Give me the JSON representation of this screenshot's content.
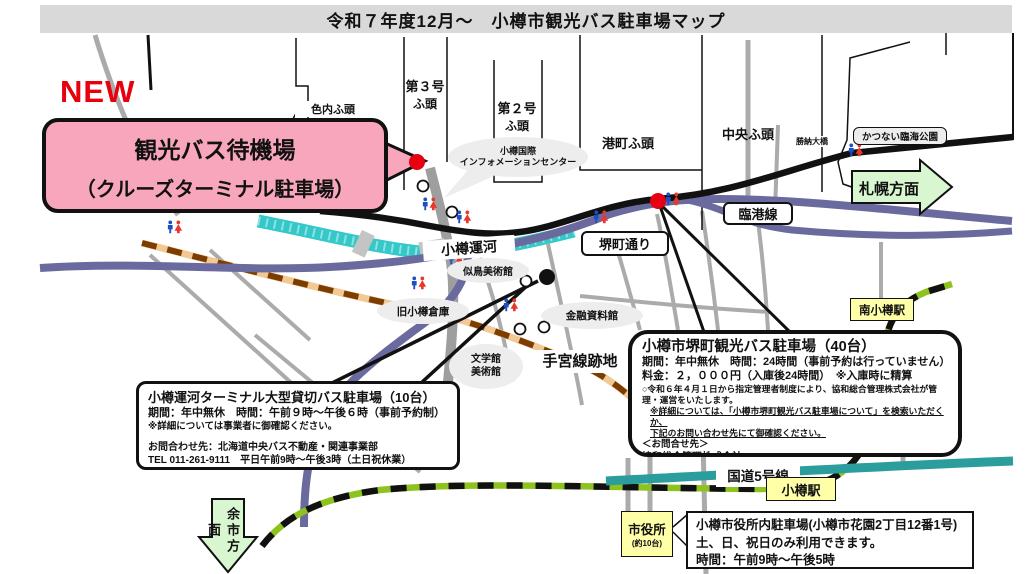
{
  "title": "令和７年度12月～　小樽市観光バス駐車場マップ",
  "new_badge": "NEW",
  "waiting_bubble": {
    "line1": "観光バス待機場",
    "line2": "（クルーズターミナル駐車場）"
  },
  "labels": {
    "ironai_pier": "色内ふ頭",
    "pier3_line1": "第３号",
    "pier3_line2": "ふ頭",
    "pier2_line1": "第２号",
    "pier2_line2": "ふ頭",
    "minatomachi_pier": "港町ふ頭",
    "chuo_pier": "中央ふ頭",
    "katsunai_park": "かつない臨海公園",
    "katsunai_bridge": "勝納大橋",
    "sapporo_direction": "札幌方面",
    "rinko_line": "臨港線",
    "otaru_canal": "小樽運河",
    "sakaimachi_street": "堺町通り",
    "info_center_line1": "小樽国際",
    "info_center_line2": "インフォメーションセンター",
    "nitori_museum": "似鳥美術館",
    "former_warehouse": "旧小樽倉庫",
    "finance_museum": "金融資料館",
    "literature_line1": "文学館",
    "literature_line2": "美術館",
    "temiya_site": "手宮線跡地",
    "minami_otaru_station": "南小樽駅",
    "otaru_station": "小樽駅",
    "route5": "国道5号線",
    "yoichi_direction": "余市方面",
    "city_hall": "市役所",
    "city_hall_capacity": "(約10台)"
  },
  "canal_box": {
    "title": "小樽運河ターミナル大型貸切バス駐車場（10台）",
    "period": "期間：年中無休　時間：午前９時～午後６時（事前予約制）",
    "note": "※詳細については事業者に御確認ください。",
    "contact1": "お問合わせ先：北海道中央バス不動産・関連事業部",
    "contact2": "TEL 011-261-9111　平日午前9時～午後3時（土日祝休業）"
  },
  "sakaimachi_box": {
    "title": "小樽市堺町観光バス駐車場（40台）",
    "period": "期間：年中無休　時間：24時間（事前予約は行っていません）",
    "fee": "料金：２，０００円（入庫後24時間）　※入庫時に精算",
    "note1": "○令和６年４月１日から指定管理者制度により、協和総合管理株式会社が管理・運営をいたします。",
    "note2": "※詳細については、「小樽市堺町観光バス駐車場について」を検索いただくか、",
    "note3": "下記のお問い合わせ先にて御確認ください。",
    "contact_header": "＜お問合せ先＞",
    "contact": "協和総合管理株式会社　TEL：0134-27-2233"
  },
  "cityhall_box": {
    "line1": "小樽市役所内駐車場(小樽市花園2丁目12番1号)",
    "line2": "土、日、祝日のみ利用できます。",
    "line3": "時間：午前9時～午後5時"
  },
  "colors": {
    "title_band": "#d9d9d9",
    "accent_pink": "#f7a6bb",
    "new_red": "#e8000e",
    "marker_red": "#e60012",
    "arrow_green": "#d8f6d0",
    "station_yellow": "#ffffa8",
    "canal_teal": "#35c8c8",
    "route5_teal": "#2b9d9d",
    "road_purple": "#6a6a9f",
    "rail_green": "#8dc21f",
    "temiya_tan": "#f2c894",
    "temiya_brown": "#7b3e00",
    "bubble_gray": "#ededed"
  }
}
